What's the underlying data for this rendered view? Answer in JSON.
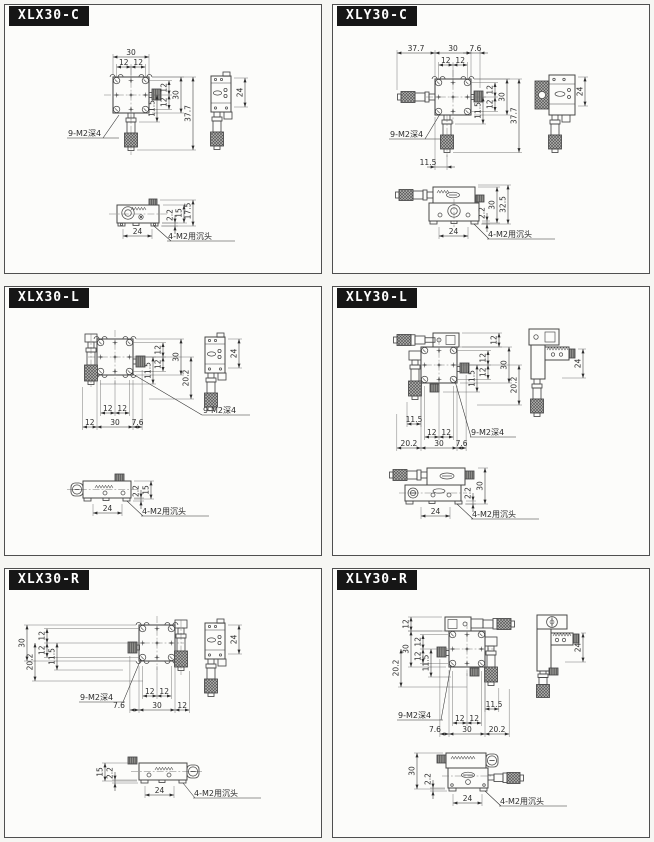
{
  "page": {
    "background": "#f6f6f3",
    "panel_background": "#fcfcfa",
    "panel_border": "#4f4f4f",
    "header_background": "#161616",
    "header_text": "#ffffff",
    "line_color": "#474747",
    "dim_text_color": "#2d2d2d"
  },
  "panels": [
    {
      "title": "XLX30-C",
      "thread_note": "9-M2深4",
      "counterbore_note": "4-M2用沉头",
      "dims": {
        "top_30": "30",
        "top_12a": "12",
        "top_12b": "12",
        "right_12a": "12",
        "right_12b": "12",
        "right_30": "30",
        "right_115": "11.5",
        "right_377": "37.7",
        "side_24": "24",
        "bottom_22": "2.2",
        "bottom_15": "15",
        "bottom_175": "17.5",
        "bottom_24": "24"
      }
    },
    {
      "title": "XLY30-C",
      "thread_note": "9-M2深4",
      "counterbore_note": "4-M2用沉头",
      "dims": {
        "top_377": "37.7",
        "top_30": "30",
        "top_76": "7.6",
        "top_12a": "12",
        "top_12b": "12",
        "right_12a": "12",
        "right_12b": "12",
        "right_30": "30",
        "right_115": "11.5",
        "right_377": "37.7",
        "offset_115": "11.5",
        "side_24": "24",
        "bottom_22": "2.2",
        "bottom_30": "30",
        "bottom_325": "32.5",
        "bottom_24": "24"
      }
    },
    {
      "title": "XLX30-L",
      "thread_note": "9-M2深4",
      "counterbore_note": "4-M2用沉头",
      "dims": {
        "right_12a": "12",
        "right_12b": "12",
        "right_30": "30",
        "right_115": "11.5",
        "right_202": "20.2",
        "pitch_12a": "12",
        "pitch_12b": "12",
        "base_12": "12",
        "base_30": "30",
        "base_76": "7.6",
        "side_24": "24",
        "bottom_22": "2.2",
        "bottom_15": "15",
        "bottom_24": "24"
      }
    },
    {
      "title": "XLY30-L",
      "thread_note": "9-M2深4",
      "counterbore_note": "4-M2用沉头",
      "dims": {
        "right_12": "12",
        "right_12a": "12",
        "right_12b": "12",
        "right_30": "30",
        "right_115": "11.5",
        "right_202": "20.2",
        "offset_115": "11.5",
        "pitch_12a": "12",
        "pitch_12b": "12",
        "base_202": "20.2",
        "base_30": "30",
        "base_76": "7.6",
        "side_24": "24",
        "bottom_22": "2.2",
        "bottom_30": "30",
        "bottom_24": "24"
      }
    },
    {
      "title": "XLX30-R",
      "thread_note": "9-M2深4",
      "counterbore_note": "4-M2用沉头",
      "dims": {
        "left_30": "30",
        "left_12a": "12",
        "left_12b": "12",
        "left_202": "20.2",
        "left_115": "11.5",
        "pitch_12a": "12",
        "pitch_12b": "12",
        "base_76": "7.6",
        "base_30": "30",
        "base_12": "12",
        "side_24": "24",
        "bottom_15": "15",
        "bottom_22": "2.2",
        "bottom_24": "24"
      }
    },
    {
      "title": "XLY30-R",
      "thread_note": "9-M2深4",
      "counterbore_note": "4-M2用沉头",
      "dims": {
        "left_12": "12",
        "left_30": "30",
        "left_12a": "12",
        "left_12b": "12",
        "left_202": "20.2",
        "left_115": "11.5",
        "offset_115": "11.5",
        "pitch_12a": "12",
        "pitch_12b": "12",
        "base_76": "7.6",
        "base_30": "30",
        "base_202": "20.2",
        "side_24": "24",
        "bottom_30": "30",
        "bottom_22": "2.2",
        "bottom_24": "24"
      }
    }
  ]
}
